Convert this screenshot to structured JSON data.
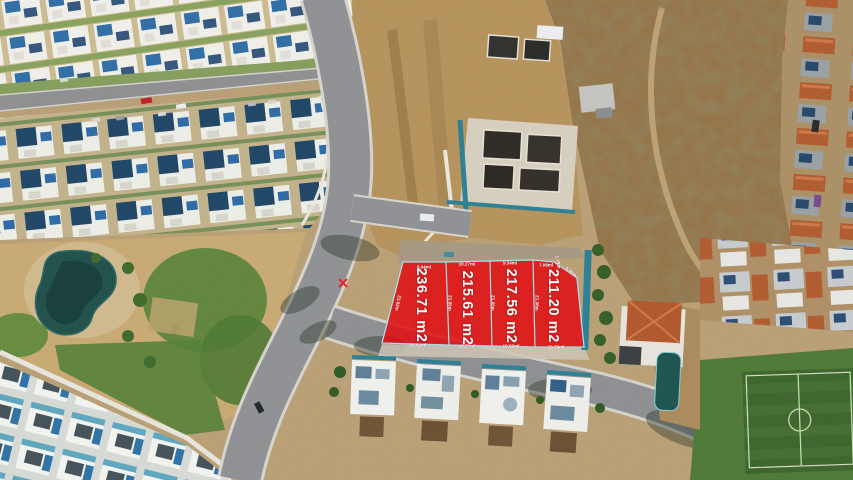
{
  "scene": {
    "description": "Aerial drone photo of a residential development; four vacant lots for sale are highlighted with a red overlay and white dimension labels",
    "overlay_color": "#e10d12",
    "boundary_color": "#aadcee",
    "label_color": "#ffffff"
  },
  "lots": [
    {
      "area_label": "236.71 m2",
      "top_dim": "5.04ml",
      "bottom_dim": "15.02ml",
      "side_dim": "23.62m"
    },
    {
      "area_label": "215.61 m2",
      "top_dim": "10.27ml",
      "bottom_dim": "10.27ml",
      "side_dim": "21.00m"
    },
    {
      "area_label": "217.56 m2",
      "top_dim": "9.34ml",
      "bottom_dim": "10.50ml",
      "side_dim": "21.00m"
    },
    {
      "area_label": "211.20 m2",
      "top_dim": "7.08ml",
      "bottom_dim": "10.79ml",
      "side_dim": "21.08m",
      "edge_dim_short": "1.79m",
      "edge_dim_long": "5.89m"
    }
  ]
}
